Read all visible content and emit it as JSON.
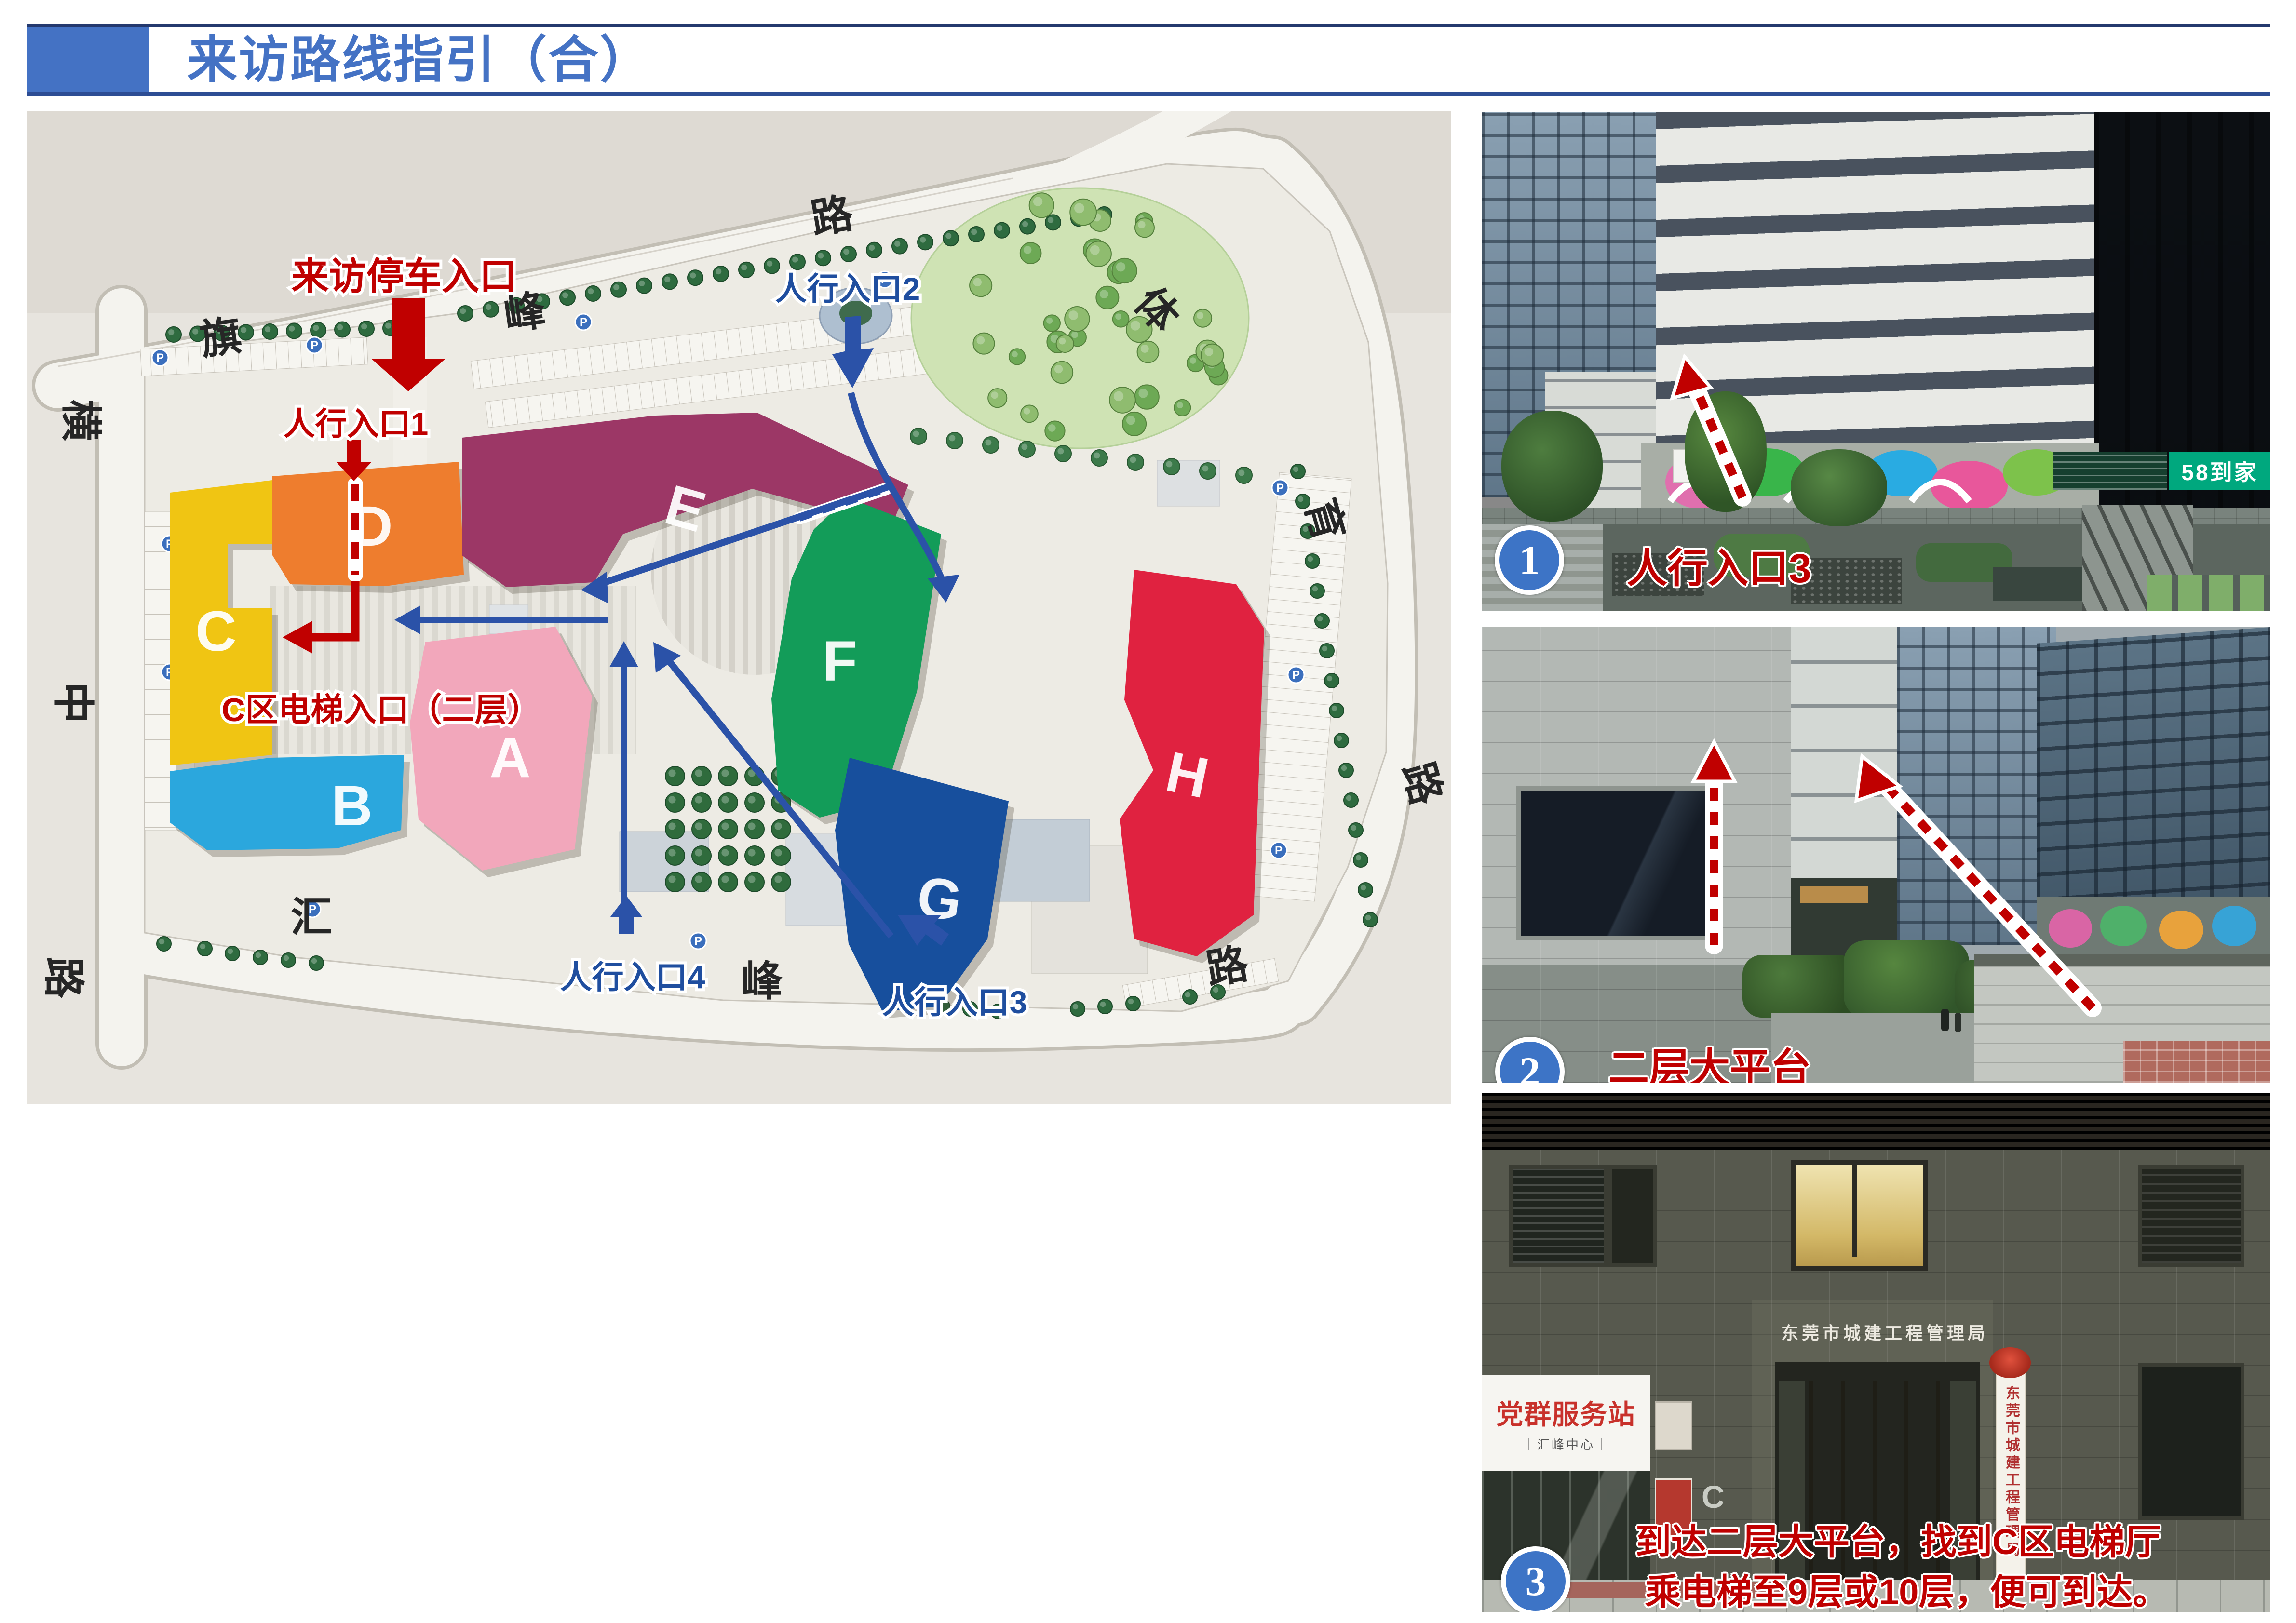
{
  "slide": {
    "title": "来访路线指引（合）",
    "accent_color": "#4472C4"
  },
  "map": {
    "annotations": {
      "parking_entrance": "来访停车入口",
      "ped_entrance_1": "人行入口1",
      "ped_entrance_2": "人行入口2",
      "ped_entrance_3": "人行入口3",
      "ped_entrance_4": "人行入口4",
      "elevator_entrance": "C区电梯入口（二层）"
    },
    "colors": {
      "red_annotation": "#C00000",
      "blue_annotation": "#2B52A8"
    },
    "buildings": [
      {
        "label": "A",
        "color": "#F2A7BB"
      },
      {
        "label": "B",
        "color": "#2BA7DD"
      },
      {
        "label": "C",
        "color": "#F0C513"
      },
      {
        "label": "D",
        "color": "#EE7D2E"
      },
      {
        "label": "E",
        "color": "#9C3766"
      },
      {
        "label": "F",
        "color": "#139C59"
      },
      {
        "label": "G",
        "color": "#174F9D"
      },
      {
        "label": "H",
        "color": "#E02240"
      }
    ],
    "road_labels": [
      {
        "text": "旗"
      },
      {
        "text": "峰"
      },
      {
        "text": "路"
      },
      {
        "text": "体"
      },
      {
        "text": "育"
      },
      {
        "text": "路"
      },
      {
        "text": "横"
      },
      {
        "text": "中"
      },
      {
        "text": "路"
      },
      {
        "text": "汇"
      },
      {
        "text": "峰"
      },
      {
        "text": "路"
      }
    ]
  },
  "photos": [
    {
      "number": "1",
      "caption": "人行入口3",
      "sign_58": "58到家"
    },
    {
      "number": "2",
      "caption": "二层大平台"
    },
    {
      "number": "3",
      "caption_line1": "到达二层大平台，找到C区电梯厅",
      "caption_line2": "乘电梯至9层或10层，便可到达。",
      "wall_sign": "东莞市城建工程管理局",
      "plaque_sign": "东莞市城建工程管理局",
      "service_sign": "党群服务站",
      "service_sub": "｜汇峰中心｜",
      "block_letter": "C"
    }
  ]
}
